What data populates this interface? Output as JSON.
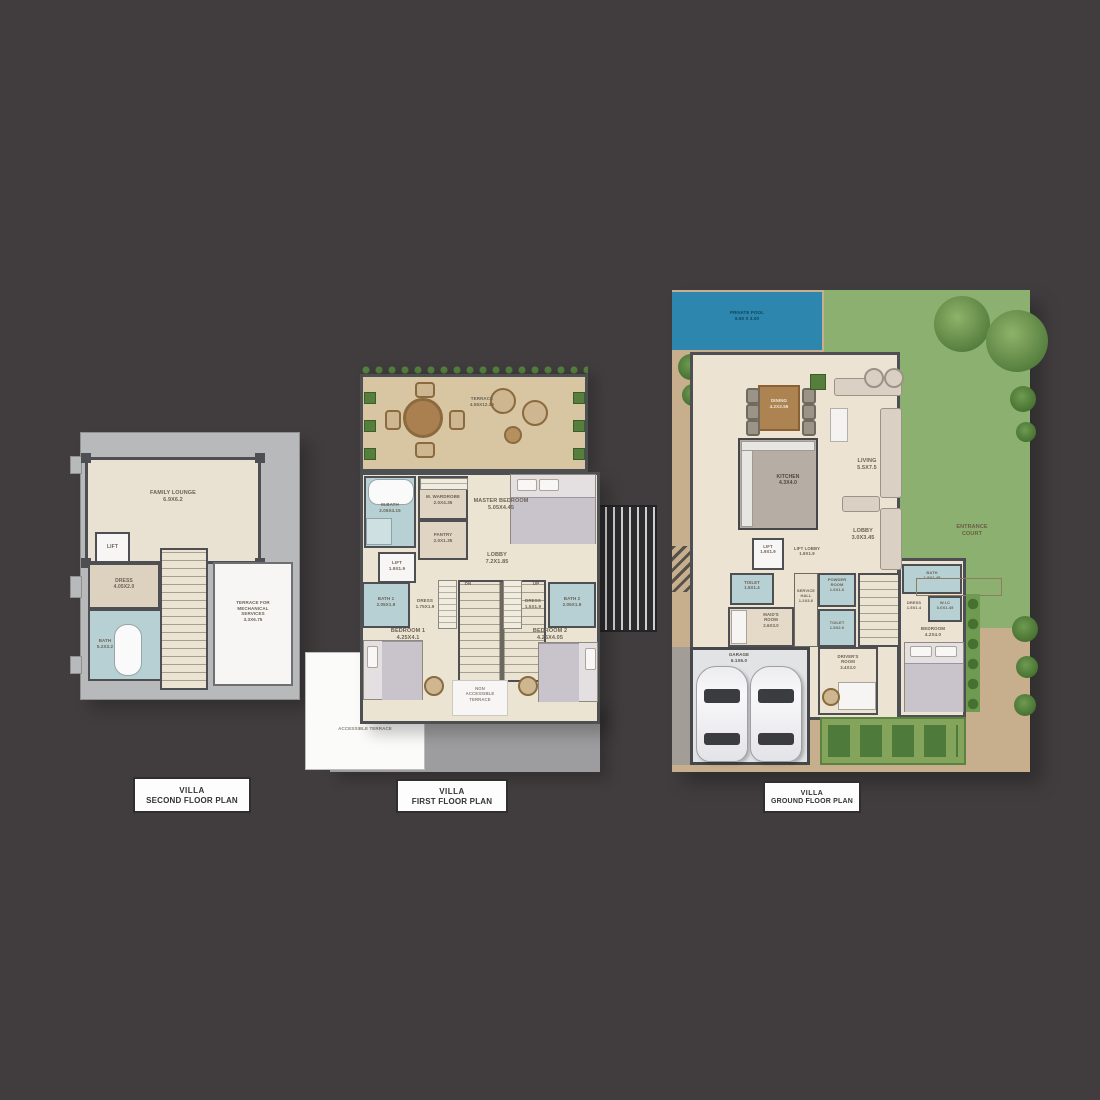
{
  "image_type": "villa floor plan sheet",
  "background_color": "#413d3e",
  "colors": {
    "wall": "#4e4f53",
    "interior_beige": "#ece4d3",
    "bath_blue": "#b7d0d4",
    "terrace_gray": "#b8b9bb",
    "deck_tan": "#c7ae8c",
    "wood_deck": "#d8c5a2",
    "pool_blue": "#2d86ae",
    "lawn_green": "#8cb070",
    "plant_green": "#567f3e",
    "garage_floor": "#e2e3e5"
  },
  "second_floor": {
    "caption_line1": "VILLA",
    "caption_line2": "SECOND FLOOR PLAN",
    "rooms": {
      "lounge": "FAMILY LOUNGE\n6.9x6.2",
      "lift": "LIFT",
      "dress": "DRESS\n4.05x2.0",
      "bath": "BATH\n5.2x3.2",
      "mech_terrace": "TERRACE FOR\nMECHANICAL\nSERVICES\n3.3x6.75"
    }
  },
  "first_floor": {
    "caption_line1": "VILLA",
    "caption_line2": "FIRST FLOOR PLAN",
    "rooms": {
      "terrace": "TERRACE\n4.55x12.15",
      "mbath": "M.BATH\n2.05x4.15",
      "mwardrobe": "M. WARDROBE\n2.0x4.35",
      "master": "MASTER BEDROOM\n5.05x4.45",
      "pantry": "PANTRY\n2.0x1.35",
      "lift": "LIFT\n1.9x1.9",
      "lobby": "LOBBY\n7.2x1.85",
      "dn": "DN",
      "up": "UP",
      "bath1": "BATH 1\n2.05x1.9",
      "dress1": "DRESS\n1.75x1.9",
      "bedroom1": "BEDROOM 1\n4.25x4.1",
      "dress2": "DRESS\n1.5x1.9",
      "bath2": "BATH 2\n2.05x1.9",
      "bedroom2": "BEDROOM 2\n4.25x4.05",
      "terrace_note": "NON\nACCESSIBLE\nTERRACE",
      "side_terrace_note": "NON\nACCESSIBLE TERRACE"
    }
  },
  "ground_floor": {
    "caption_line1": "VILLA",
    "caption_line2": "GROUND FLOOR PLAN",
    "rooms": {
      "pool": "PRIVATE POOL\n6.50 x 3.00",
      "dining": "DINING\n4.2x3.55",
      "living": "LIVING\n5.5x7.5",
      "kitchen": "KITCHEN\n4.3x4.0",
      "lobby": "LOBBY\n3.0x3.45",
      "lift": "LIFT\n1.9x1.9",
      "lift_lobby": "LIFT LOBBY\n1.9x1.9",
      "toilet": "TOILET\n1.5x1.4",
      "maids": "MAID'S\nROOM\n2.6x3.0",
      "service_hall": "SERVICE\nHALL\n1.2x3.6",
      "powder": "POWDER\nROOM\n1.6x1.6",
      "toilet2": "TOILET\n1.5x2.0",
      "bath": "BATH\n1.9x1.45",
      "dress": "DRESS\n1.5x1.4",
      "wic": "W.I.C\n3.0x1.45",
      "bedroom": "BEDROOM\n4.2x4.0",
      "drivers": "DRIVER'S\nROOM\n3.4x3.0",
      "store": "STORE\n1.6x1.6",
      "hob": "HOB\n1.8x1.6",
      "garage": "GARAGE\n6.1x6.0",
      "entrance_court": "ENTRANCE\nCOURT"
    }
  }
}
